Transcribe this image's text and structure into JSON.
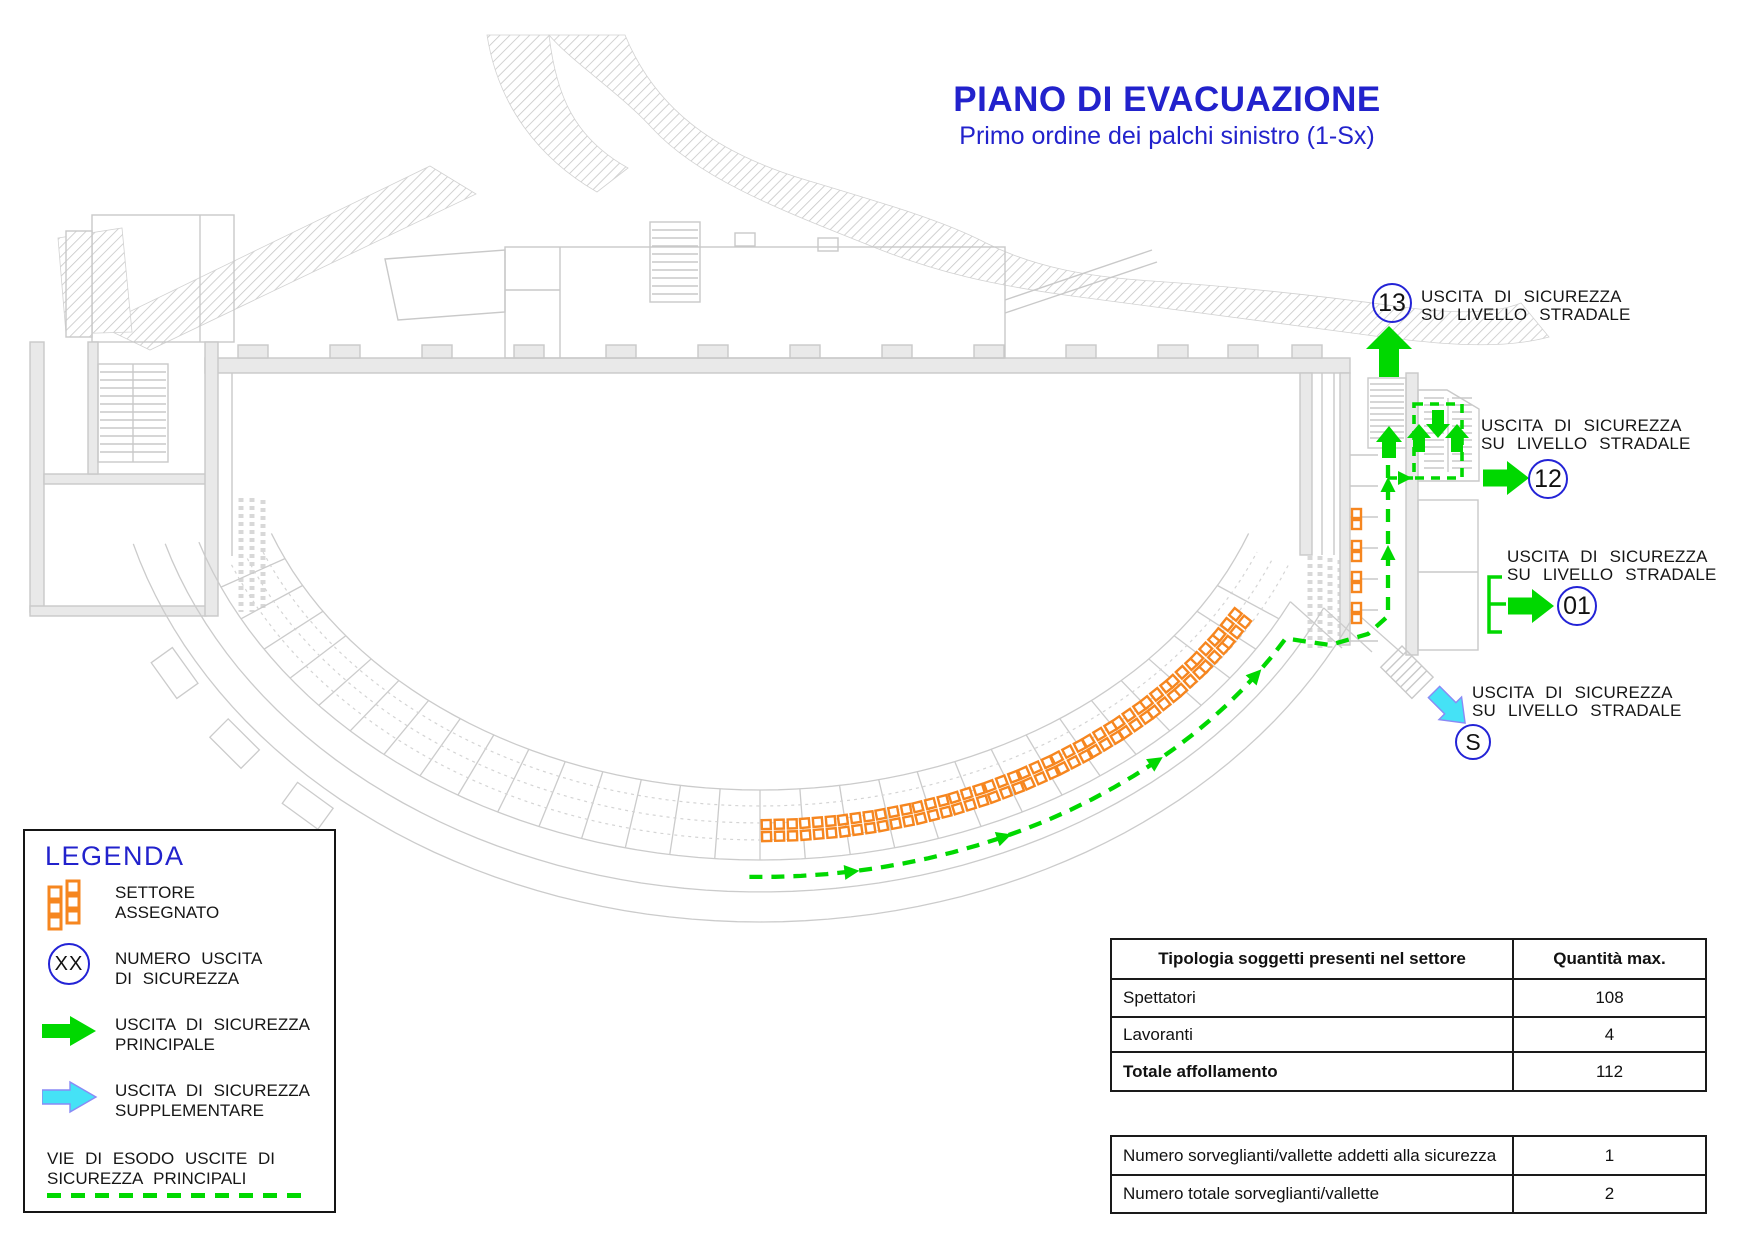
{
  "title": "PIANO DI EVACUAZIONE",
  "subtitle": "Primo ordine dei palchi sinistro (1-Sx)",
  "exits": [
    {
      "id": "13",
      "line1": "USCITA DI SICUREZZA",
      "line2": "SU LIVELLO STRADALE"
    },
    {
      "id": "12",
      "line1": "USCITA DI SICUREZZA",
      "line2": "SU LIVELLO STRADALE"
    },
    {
      "id": "01",
      "line1": "USCITA DI SICUREZZA",
      "line2": "SU LIVELLO STRADALE"
    },
    {
      "id": "S",
      "line1": "USCITA DI SICUREZZA",
      "line2": "SU LIVELLO STRADALE"
    }
  ],
  "legend": {
    "title": "LEGENDA",
    "items": [
      {
        "icon": "sector-seats-icon",
        "symbol": "",
        "lines": [
          "SETTORE",
          "ASSEGNATO"
        ]
      },
      {
        "icon": "exit-number-circle-icon",
        "symbol": "XX",
        "lines": [
          "NUMERO USCITA",
          "DI SICUREZZA"
        ]
      },
      {
        "icon": "green-arrow-icon",
        "symbol": "",
        "lines": [
          "USCITA DI SICUREZZA",
          "PRINCIPALE"
        ]
      },
      {
        "icon": "cyan-arrow-icon",
        "symbol": "",
        "lines": [
          "USCITA DI SICUREZZA",
          "SUPPLEMENTARE"
        ]
      },
      {
        "icon": "green-dashed-line-icon",
        "symbol": "",
        "lines": [
          "VIE DI ESODO USCITE DI",
          "SICUREZZA PRINCIPALI"
        ]
      }
    ]
  },
  "table": {
    "headers": [
      "Tipologia soggetti presenti nel settore",
      "Quantità max."
    ],
    "top_rows": [
      {
        "label": "Spettatori",
        "value": "108",
        "bold": false
      },
      {
        "label": "Lavoranti",
        "value": "4",
        "bold": false
      },
      {
        "label": "Totale affollamento",
        "value": "112",
        "bold": true
      }
    ],
    "bottom_rows": [
      {
        "label": "Numero sorveglianti/vallette addetti alla sicurezza",
        "value": "1",
        "bold": false
      },
      {
        "label": "Numero totale sorveglianti/vallette",
        "value": "2",
        "bold": false
      }
    ]
  },
  "colors": {
    "blue": "#2222cc",
    "green": "#00d800",
    "cyan": "#45e2f6",
    "orange": "#f6861f",
    "plan_gray": "#cbcbcb"
  }
}
